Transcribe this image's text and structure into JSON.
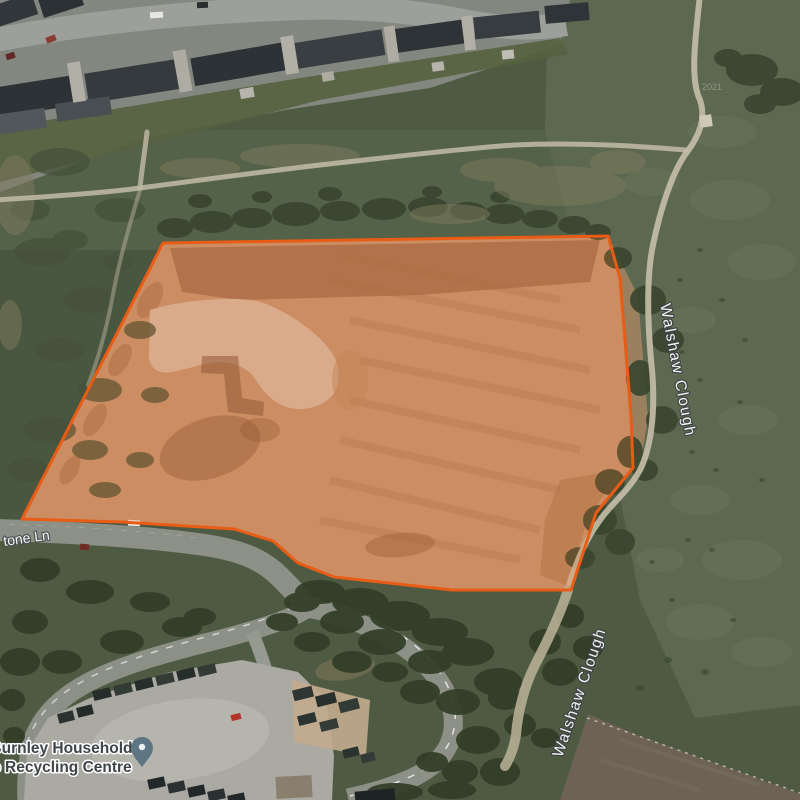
{
  "map": {
    "view_type": "satellite",
    "attribution_year": "2021",
    "labels": {
      "waterway_upper": {
        "text": "Walshaw Clough",
        "x": 673,
        "y": 371,
        "rotate": 79
      },
      "waterway_lower": {
        "text": "Walshaw Clough",
        "x": 584,
        "y": 694,
        "rotate": -71
      },
      "street": {
        "text": "tone Ln",
        "x": 4,
        "y": 546,
        "rotate": -8
      },
      "poi_line1": {
        "text": "s Burnley Household",
        "x": 55,
        "y": 753,
        "rotate": 0
      },
      "poi_line2": {
        "text": "ste Recycling Centre",
        "x": 55,
        "y": 772,
        "rotate": 0
      }
    },
    "pin": {
      "x": 142,
      "y": 753
    },
    "site_overlay": {
      "points": "163,243 608,236 620,278 631,415 633,468 596,513 571,590 452,590 334,577 298,563 273,541 234,529 121,522 22,519",
      "stroke_width": 3,
      "fill_opacity": 0.2
    }
  },
  "colors": {
    "site_stroke": "#e85c15",
    "site_fill": "#f07328",
    "pin_body": "#5e7683",
    "pin_dot": "#eef1f2",
    "water_label": "#ffffff",
    "water_halo": "#3e4347",
    "street_label": "#ffffff",
    "street_halo": "#4a4e52",
    "poi_label": "#3f4448",
    "poi_halo": "#ffffff"
  },
  "terrain": {
    "tree_groups": [
      {
        "layer": "upper",
        "color": "#39452e",
        "opacity": 0.9,
        "blobs": [
          [
            175,
            228,
            18,
            10
          ],
          [
            212,
            222,
            22,
            11
          ],
          [
            252,
            218,
            20,
            10
          ],
          [
            296,
            214,
            24,
            12
          ],
          [
            340,
            211,
            20,
            10
          ],
          [
            384,
            209,
            22,
            11
          ],
          [
            428,
            207,
            20,
            10
          ],
          [
            468,
            211,
            18,
            9
          ],
          [
            504,
            214,
            20,
            10
          ],
          [
            540,
            219,
            18,
            9
          ],
          [
            574,
            225,
            16,
            9
          ],
          [
            598,
            232,
            13,
            8
          ],
          [
            200,
            201,
            12,
            7
          ],
          [
            262,
            197,
            10,
            6
          ],
          [
            330,
            194,
            12,
            7
          ],
          [
            432,
            192,
            10,
            6
          ],
          [
            500,
            197,
            10,
            6
          ],
          [
            752,
            70,
            26,
            16
          ],
          [
            782,
            92,
            22,
            14
          ],
          [
            760,
            104,
            16,
            10
          ],
          [
            728,
            58,
            14,
            9
          ],
          [
            618,
            258,
            14,
            11
          ],
          [
            648,
            300,
            18,
            15
          ],
          [
            668,
            340,
            16,
            13
          ],
          [
            640,
            378,
            14,
            18
          ],
          [
            662,
            420,
            16,
            14
          ],
          [
            630,
            452,
            13,
            16
          ],
          [
            645,
            470,
            13,
            11
          ],
          [
            610,
            482,
            15,
            13
          ],
          [
            600,
            520,
            17,
            15
          ],
          [
            620,
            542,
            15,
            13
          ],
          [
            580,
            558,
            15,
            11
          ]
        ]
      },
      {
        "layer": "upper",
        "color": "#46523a",
        "opacity": 0.8,
        "blobs": [
          [
            60,
            162,
            30,
            14
          ],
          [
            120,
            210,
            25,
            12
          ],
          [
            42,
            252,
            28,
            14
          ],
          [
            90,
            300,
            26,
            13
          ],
          [
            60,
            350,
            24,
            12
          ],
          [
            100,
            390,
            22,
            12
          ],
          [
            50,
            430,
            26,
            13
          ],
          [
            28,
            470,
            20,
            12
          ],
          [
            90,
            450,
            18,
            10
          ],
          [
            140,
            330,
            16,
            9
          ],
          [
            118,
            262,
            15,
            9
          ],
          [
            155,
            395,
            14,
            8
          ],
          [
            70,
            240,
            18,
            10
          ],
          [
            30,
            210,
            20,
            11
          ],
          [
            140,
            460,
            14,
            8
          ],
          [
            105,
            490,
            16,
            8
          ]
        ]
      },
      {
        "layer": "upper",
        "color": "#6a775c",
        "opacity": 0.45,
        "blobs": [
          [
            730,
            200,
            40,
            20
          ],
          [
            762,
            262,
            34,
            18
          ],
          [
            700,
            500,
            30,
            15
          ],
          [
            742,
            560,
            40,
            20
          ],
          [
            700,
            622,
            34,
            18
          ],
          [
            762,
            652,
            30,
            15
          ],
          [
            652,
            182,
            28,
            14
          ],
          [
            722,
            132,
            34,
            16
          ],
          [
            690,
            320,
            26,
            13
          ],
          [
            748,
            420,
            30,
            15
          ],
          [
            660,
            560,
            24,
            12
          ]
        ]
      },
      {
        "layer": "upper",
        "color": "#39462f",
        "opacity": 0.6,
        "blobs": [
          [
            700,
            250,
            3,
            2
          ],
          [
            722,
            300,
            3,
            2
          ],
          [
            682,
            352,
            3,
            2
          ],
          [
            740,
            402,
            3,
            2
          ],
          [
            692,
            452,
            3,
            2
          ],
          [
            712,
            550,
            3,
            2
          ],
          [
            672,
            600,
            3,
            2
          ],
          [
            733,
            620,
            3,
            2
          ],
          [
            652,
            562,
            3,
            2
          ],
          [
            762,
            480,
            3,
            2
          ],
          [
            700,
            380,
            3,
            2
          ],
          [
            680,
            280,
            3,
            2
          ],
          [
            745,
            340,
            3,
            2
          ],
          [
            716,
            470,
            3,
            2
          ],
          [
            688,
            540,
            3,
            2
          ],
          [
            668,
            660,
            4,
            3
          ],
          [
            705,
            672,
            4,
            3
          ],
          [
            640,
            688,
            4,
            3
          ]
        ]
      },
      {
        "layer": "upper",
        "color": "#7e7a5d",
        "opacity": 0.5,
        "blobs": [
          [
            300,
            156,
            60,
            12
          ],
          [
            560,
            186,
            66,
            20
          ],
          [
            450,
            214,
            40,
            10
          ],
          [
            618,
            162,
            28,
            12
          ],
          [
            200,
            168,
            40,
            10
          ],
          [
            15,
            195,
            20,
            40
          ],
          [
            10,
            325,
            12,
            25
          ],
          [
            500,
            170,
            40,
            12
          ]
        ]
      },
      {
        "layer": "lower",
        "color": "#313d27",
        "opacity": 0.92,
        "blobs": [
          [
            320,
            592,
            25,
            12
          ],
          [
            360,
            602,
            28,
            14
          ],
          [
            400,
            616,
            30,
            15
          ],
          [
            440,
            632,
            28,
            14
          ],
          [
            468,
            652,
            26,
            14
          ],
          [
            430,
            662,
            22,
            12
          ],
          [
            382,
            642,
            24,
            13
          ],
          [
            342,
            622,
            22,
            12
          ],
          [
            302,
            602,
            18,
            10
          ],
          [
            498,
            682,
            24,
            14
          ],
          [
            352,
            662,
            20,
            11
          ],
          [
            312,
            642,
            18,
            10
          ],
          [
            282,
            622,
            16,
            9
          ],
          [
            458,
            702,
            22,
            13
          ],
          [
            420,
            692,
            20,
            12
          ],
          [
            390,
            672,
            18,
            10
          ],
          [
            545,
            642,
            16,
            13
          ],
          [
            560,
            672,
            18,
            14
          ],
          [
            505,
            698,
            17,
            12
          ],
          [
            478,
            740,
            22,
            14
          ],
          [
            500,
            772,
            20,
            14
          ],
          [
            460,
            772,
            18,
            12
          ],
          [
            432,
            762,
            16,
            10
          ],
          [
            545,
            738,
            14,
            10
          ],
          [
            395,
            792,
            28,
            9
          ],
          [
            452,
            790,
            24,
            9
          ],
          [
            40,
            570,
            20,
            12
          ],
          [
            90,
            592,
            24,
            12
          ],
          [
            150,
            602,
            20,
            10
          ],
          [
            30,
            622,
            18,
            12
          ],
          [
            200,
            617,
            16,
            9
          ],
          [
            62,
            662,
            20,
            12
          ],
          [
            122,
            642,
            22,
            12
          ],
          [
            182,
            627,
            20,
            10
          ],
          [
            20,
            662,
            20,
            14
          ],
          [
            12,
            700,
            13,
            11
          ],
          [
            14,
            736,
            11,
            9
          ],
          [
            570,
            616,
            14,
            12
          ],
          [
            588,
            648,
            15,
            12
          ],
          [
            520,
            725,
            16,
            12
          ]
        ]
      }
    ]
  },
  "objects": {
    "rects": [
      [
        -14,
        82,
        90,
        30,
        -9,
        "#2c3235"
      ],
      [
        86,
        66,
        96,
        30,
        -9,
        "#343a3d"
      ],
      [
        192,
        50,
        96,
        28,
        -10,
        "#2c3235"
      ],
      [
        296,
        36,
        88,
        26,
        -9,
        "#383e41"
      ],
      [
        396,
        24,
        70,
        24,
        -8,
        "#2d3336"
      ],
      [
        474,
        14,
        66,
        22,
        -6,
        "#363c3f"
      ],
      [
        545,
        4,
        44,
        18,
        -5,
        "#2e3437"
      ],
      [
        -12,
        0,
        48,
        22,
        -18,
        "#31373a"
      ],
      [
        40,
        -8,
        42,
        20,
        -18,
        "#2b3134"
      ],
      [
        -14,
        112,
        60,
        20,
        -8,
        "#51575a"
      ],
      [
        56,
        100,
        55,
        18,
        -8,
        "#484e51"
      ],
      [
        70,
        62,
        13,
        40,
        -9,
        "#b2afa6"
      ],
      [
        176,
        50,
        13,
        42,
        -10,
        "#aeaba2"
      ],
      [
        283,
        36,
        13,
        38,
        -9,
        "#b2afa6"
      ],
      [
        386,
        26,
        11,
        36,
        -8,
        "#aeaba2"
      ],
      [
        463,
        16,
        11,
        34,
        -7,
        "#b2afa6"
      ],
      [
        240,
        88,
        14,
        10,
        -10,
        "#b7b4ab"
      ],
      [
        322,
        72,
        12,
        9,
        -10,
        "#aeaba2"
      ],
      [
        432,
        62,
        12,
        9,
        -8,
        "#b7b4ab"
      ],
      [
        502,
        50,
        12,
        9,
        -6,
        "#c0bdb4"
      ],
      [
        150,
        12,
        13,
        6,
        -3,
        "#e6e6e2"
      ],
      [
        197,
        2,
        11,
        6,
        -2,
        "#2a2d30"
      ],
      [
        46,
        36,
        10,
        6,
        -20,
        "#8a3b30"
      ],
      [
        6,
        53,
        9,
        6,
        -18,
        "#5f2723"
      ],
      [
        128,
        520,
        12,
        6,
        3,
        "#eceae4"
      ],
      [
        80,
        544,
        9,
        6,
        5,
        "#702c24"
      ],
      [
        231,
        714,
        10,
        6,
        -14,
        "#b2352a"
      ],
      [
        93,
        689,
        18,
        10,
        -14,
        "#262e2b"
      ],
      [
        114,
        684,
        18,
        10,
        -14,
        "#333b37"
      ],
      [
        135,
        679,
        18,
        10,
        -14,
        "#262e2b"
      ],
      [
        156,
        674,
        18,
        10,
        -14,
        "#333b37"
      ],
      [
        177,
        669,
        18,
        10,
        -14,
        "#262e2b"
      ],
      [
        198,
        665,
        18,
        10,
        -14,
        "#333b37"
      ],
      [
        58,
        712,
        16,
        10,
        -14,
        "#2b3330"
      ],
      [
        77,
        706,
        16,
        10,
        -14,
        "#242c29"
      ],
      [
        293,
        688,
        20,
        11,
        -14,
        "#2e3633"
      ],
      [
        316,
        694,
        20,
        11,
        -14,
        "#27302c"
      ],
      [
        339,
        700,
        20,
        11,
        -14,
        "#323a36"
      ],
      [
        298,
        714,
        18,
        10,
        -14,
        "#2b3330"
      ],
      [
        320,
        720,
        18,
        10,
        -14,
        "#343c38"
      ],
      [
        343,
        748,
        16,
        9,
        -14,
        "#2b3330"
      ],
      [
        361,
        753,
        14,
        9,
        -14,
        "#333b37"
      ],
      [
        148,
        778,
        17,
        10,
        -12,
        "#23282b"
      ],
      [
        168,
        782,
        17,
        10,
        -12,
        "#2b3033"
      ],
      [
        188,
        786,
        17,
        10,
        -12,
        "#23282b"
      ],
      [
        208,
        790,
        17,
        10,
        -12,
        "#2b3033"
      ],
      [
        228,
        794,
        17,
        10,
        -12,
        "#23282b"
      ],
      [
        355,
        790,
        40,
        12,
        -5,
        "#1e2326"
      ],
      [
        276,
        776,
        36,
        22,
        -3,
        "#8a7f6d"
      ],
      [
        700,
        115,
        12,
        12,
        -8,
        "#cfc9b8"
      ]
    ]
  }
}
